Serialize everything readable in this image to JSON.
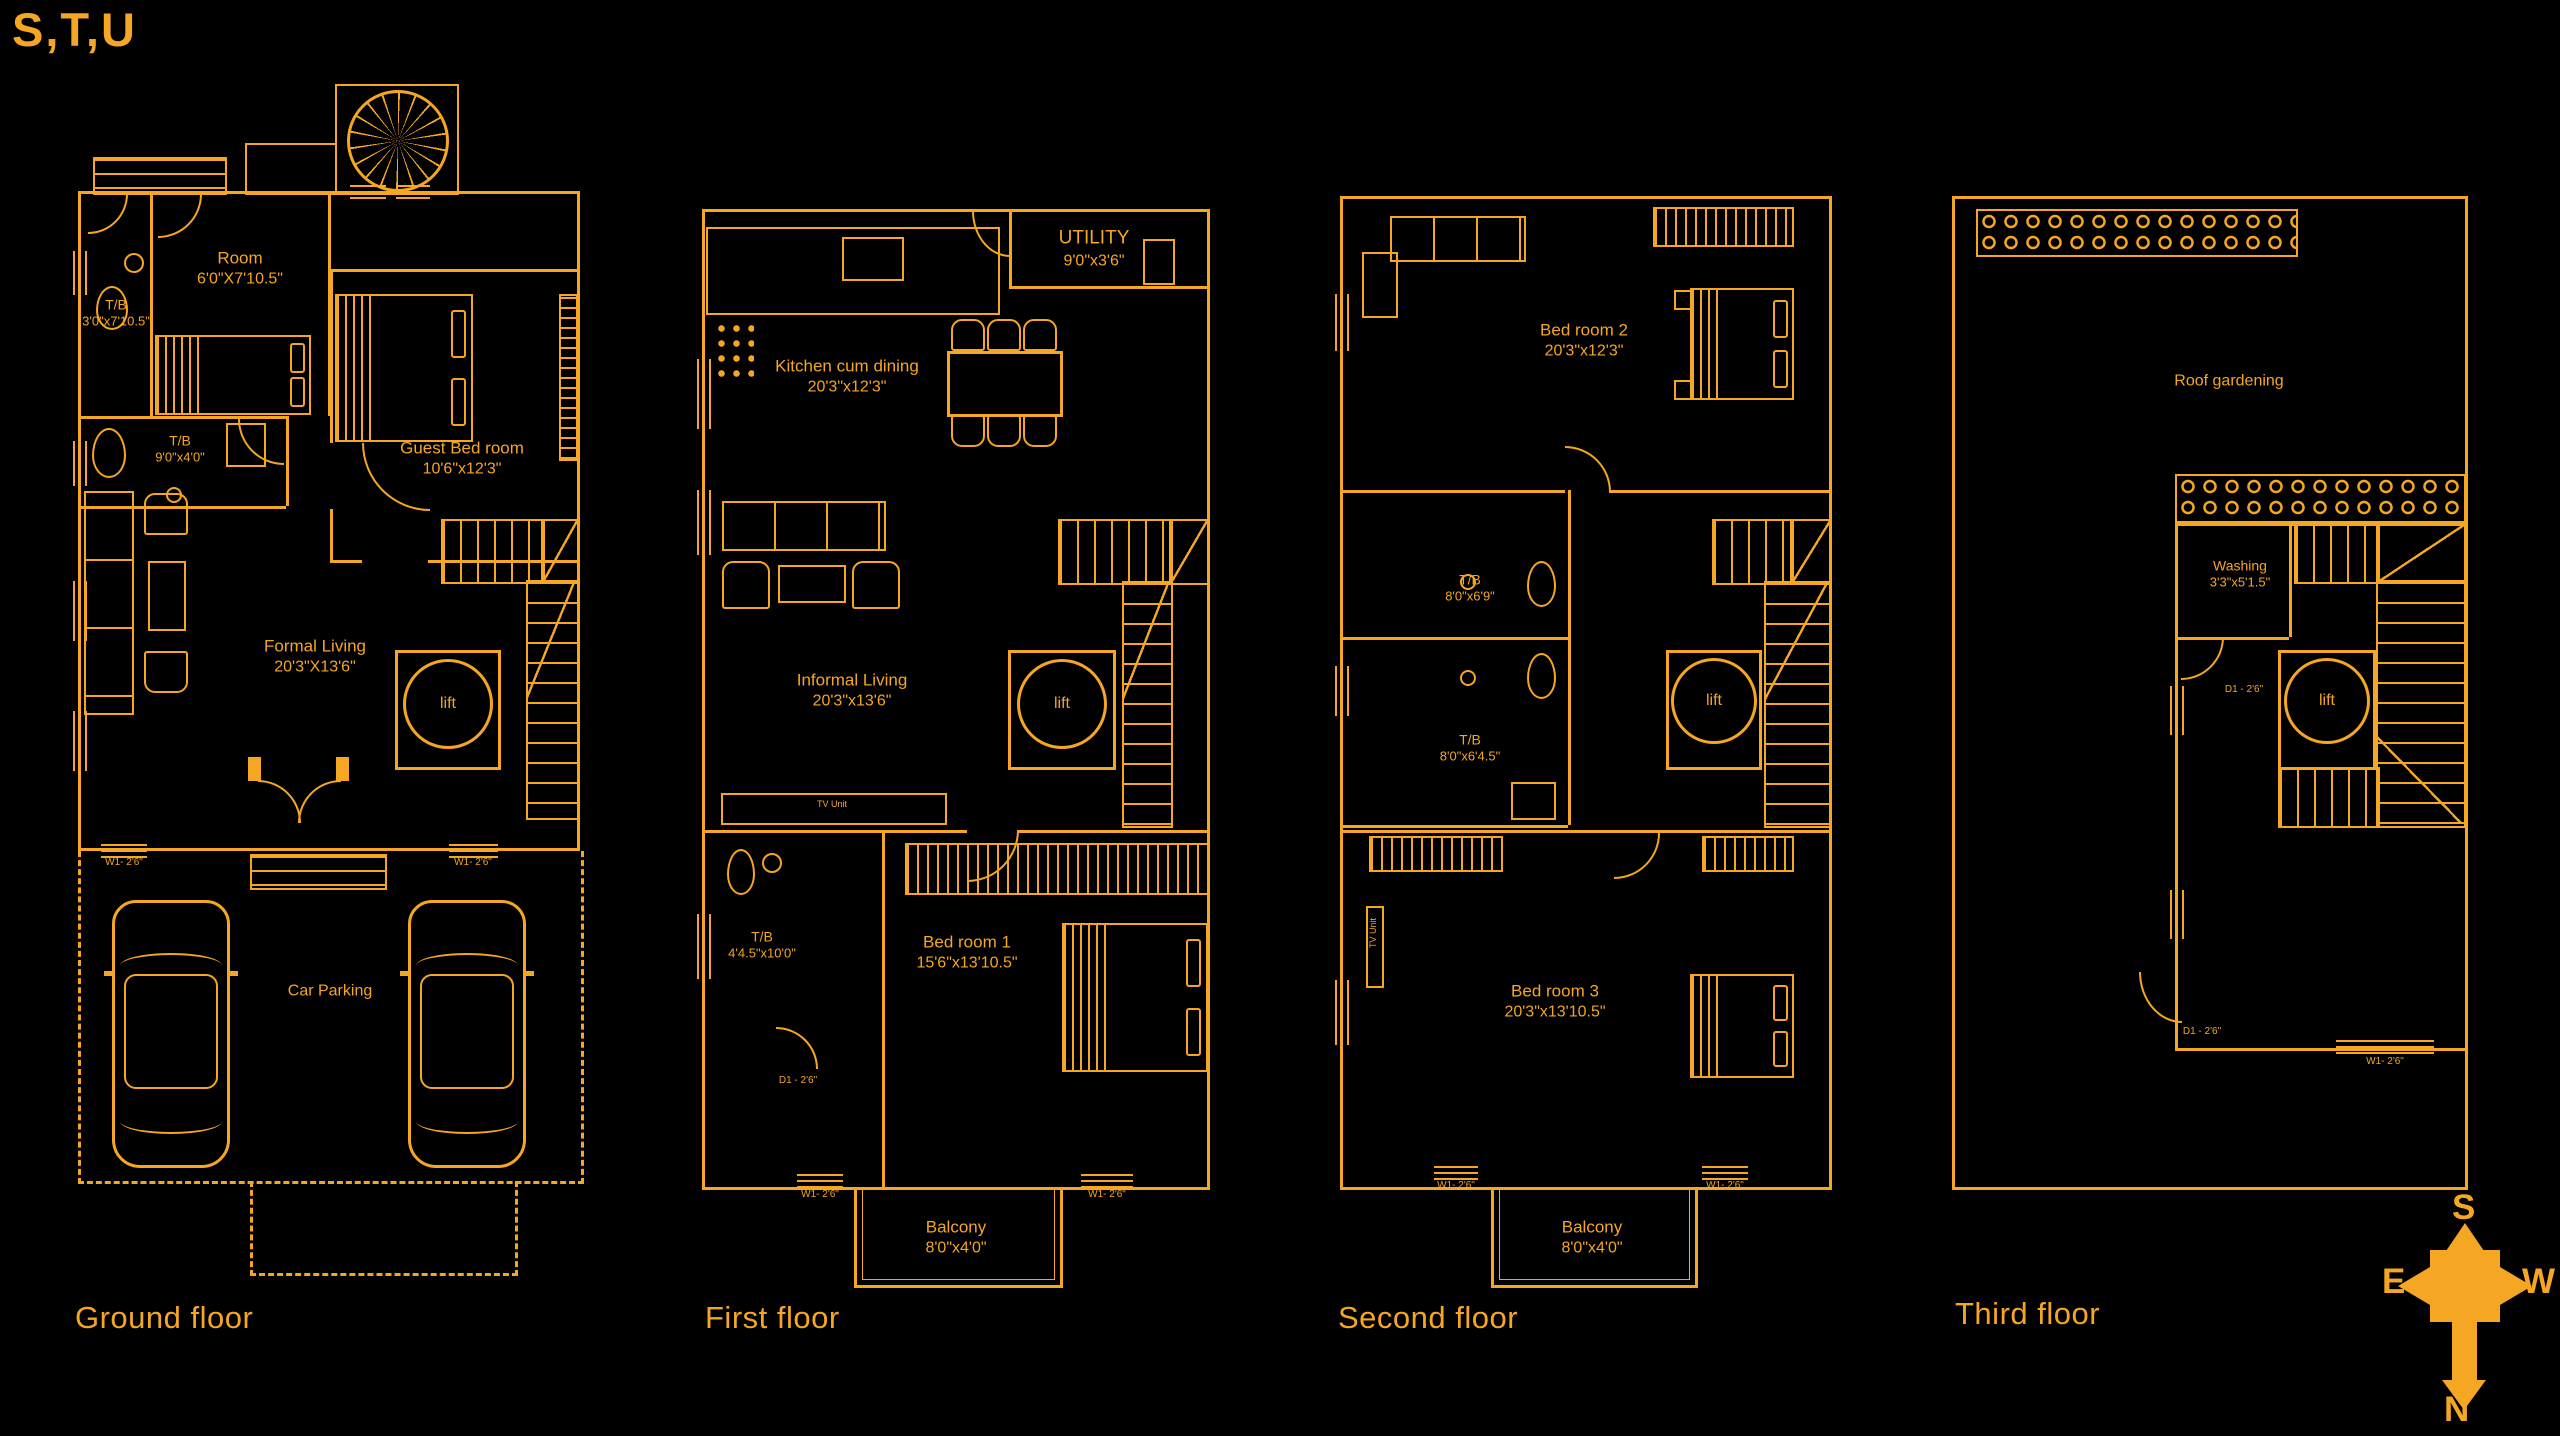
{
  "title": "S,T,U",
  "accent": "#F5A623",
  "compass": {
    "n": "N",
    "s": "S",
    "e": "E",
    "w": "W"
  },
  "tags": {
    "window": "W1- 2'6\"",
    "door": "D1 - 2'6\"",
    "tv_unit": "TV Unit"
  },
  "floors": {
    "ground": {
      "label": "Ground floor",
      "rooms": {
        "tb1": {
          "name": "T/B",
          "dims": "3'0\"x7'10.5\""
        },
        "maid_room": {
          "name": "Room",
          "dims": "6'0\"X7'10.5\""
        },
        "tb2": {
          "name": "T/B",
          "dims": "9'0\"x4'0\""
        },
        "guest": {
          "name": "Guest Bed room",
          "dims": "10'6\"x12'3\""
        },
        "formal": {
          "name": "Formal Living",
          "dims": "20'3\"X13'6\""
        },
        "lift": {
          "name": "lift"
        },
        "parking": {
          "name": "Car Parking"
        }
      }
    },
    "first": {
      "label": "First floor",
      "rooms": {
        "utility": {
          "name": "UTILITY",
          "dims": "9'0\"x3'6\""
        },
        "kitchen": {
          "name": "Kitchen cum dining",
          "dims": "20'3\"x12'3\""
        },
        "informal": {
          "name": "Informal Living",
          "dims": "20'3\"x13'6\""
        },
        "tb": {
          "name": "T/B",
          "dims": "4'4.5\"x10'0\""
        },
        "bed1": {
          "name": "Bed room 1",
          "dims": "15'6\"x13'10.5\""
        },
        "balcony": {
          "name": "Balcony",
          "dims": "8'0\"x4'0\""
        },
        "lift": {
          "name": "lift"
        }
      }
    },
    "second": {
      "label": "Second floor",
      "rooms": {
        "bed2": {
          "name": "Bed room 2",
          "dims": "20'3\"x12'3\""
        },
        "tb1": {
          "name": "T/B",
          "dims": "8'0\"x6'9\""
        },
        "tb2": {
          "name": "T/B",
          "dims": "8'0\"x6'4.5\""
        },
        "bed3": {
          "name": "Bed room 3",
          "dims": "20'3\"x13'10.5\""
        },
        "balcony": {
          "name": "Balcony",
          "dims": "8'0\"x4'0\""
        },
        "lift": {
          "name": "lift"
        }
      }
    },
    "third": {
      "label": "Third floor",
      "rooms": {
        "roof": {
          "name": "Roof gardening"
        },
        "washing": {
          "name": "Washing",
          "dims": "3'3\"x5'1.5\""
        },
        "lift": {
          "name": "lift"
        }
      }
    }
  }
}
